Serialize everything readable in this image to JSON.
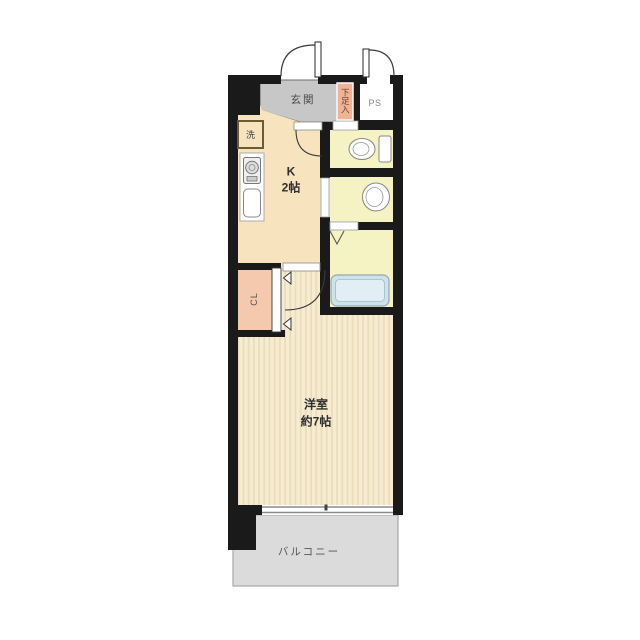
{
  "floorplan": {
    "entrance": {
      "label": "玄関"
    },
    "shoe_storage": {
      "label": "下足入"
    },
    "pipe_space": {
      "label": "PS"
    },
    "laundry": {
      "label": "洗"
    },
    "kitchen": {
      "label": "K",
      "size": "2帖"
    },
    "closet": {
      "label": "CL"
    },
    "western_room": {
      "label": "洋室",
      "size": "約7帖"
    },
    "balcony": {
      "label": "バルコニー"
    },
    "colors": {
      "wall": "#1a1a1a",
      "entrance_floor": "#c7c7c7",
      "kitchen_floor": "#f8e3bf",
      "wet_room_floor": "#f5f2c4",
      "pipe_space_floor": "#ffffff",
      "closet_fill": "#f5c9ae",
      "shoe_storage_fill": "#f2b394",
      "room_floor": "#f7ecd2",
      "room_stripe": "#eaddbc",
      "balcony_floor": "#dbdbdb",
      "bathtub_fill": "#cce3ee"
    }
  }
}
